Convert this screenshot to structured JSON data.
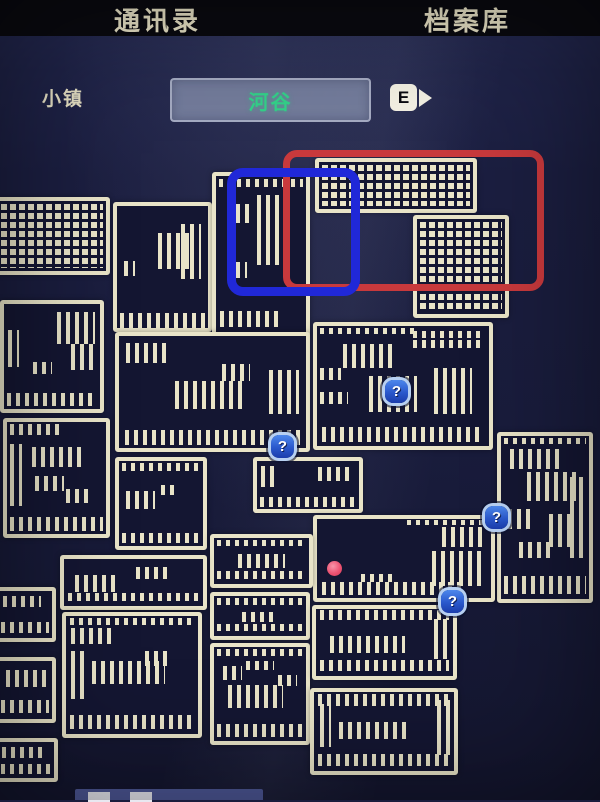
{
  "header": {
    "tabs": [
      {
        "id": "contacts",
        "label": "通讯录"
      },
      {
        "id": "archive",
        "label": "档案库"
      }
    ]
  },
  "location_bar": {
    "area_label": "小镇",
    "location_name": "河谷",
    "key_hint": "E"
  },
  "colors": {
    "background": "#1a1d3d",
    "room_fill": "#141632",
    "room_line": "#e9e4c8",
    "red_annotation": "#c8393c",
    "blue_annotation": "#2028d8",
    "marker_blue": "#2c5fd6",
    "player_pink": "#ec5372",
    "location_green": "#33d189"
  },
  "map": {
    "rooms": [
      {
        "x": -6,
        "y": 197,
        "w": 116,
        "h": 78,
        "p": "grid",
        "d": []
      },
      {
        "x": 113,
        "y": 202,
        "w": 99,
        "h": 130,
        "p": "s",
        "d": [
          [
            3,
            88,
            94,
            12
          ],
          [
            45,
            22,
            35,
            30
          ],
          [
            70,
            15,
            22,
            45
          ],
          [
            8,
            45,
            12,
            12
          ]
        ]
      },
      {
        "x": 212,
        "y": 172,
        "w": 98,
        "h": 165,
        "p": "s",
        "d": [
          [
            3,
            2,
            94,
            5
          ],
          [
            12,
            18,
            28,
            12
          ],
          [
            45,
            12,
            30,
            45
          ],
          [
            22,
            55,
            12,
            10
          ],
          [
            4,
            86,
            70,
            10
          ]
        ]
      },
      {
        "x": 315,
        "y": 158,
        "w": 162,
        "h": 55,
        "p": "grid",
        "d": []
      },
      {
        "x": 413,
        "y": 215,
        "w": 96,
        "h": 103,
        "p": "grid",
        "d": []
      },
      {
        "x": 0,
        "y": 300,
        "w": 104,
        "h": 113,
        "p": "s",
        "d": [
          [
            3,
            85,
            94,
            12
          ],
          [
            4,
            25,
            12,
            35
          ],
          [
            55,
            8,
            40,
            30
          ],
          [
            70,
            38,
            25,
            25
          ],
          [
            30,
            55,
            20,
            12
          ]
        ]
      },
      {
        "x": 115,
        "y": 332,
        "w": 195,
        "h": 120,
        "p": "s",
        "d": [
          [
            3,
            84,
            94,
            13
          ],
          [
            4,
            6,
            22,
            18
          ],
          [
            30,
            40,
            38,
            25
          ],
          [
            55,
            25,
            15,
            15
          ],
          [
            80,
            30,
            16,
            40
          ]
        ]
      },
      {
        "x": 313,
        "y": 322,
        "w": 180,
        "h": 128,
        "p": "s",
        "d": [
          [
            2,
            2,
            55,
            5
          ],
          [
            56,
            4,
            40,
            6
          ],
          [
            56,
            12,
            40,
            6
          ],
          [
            15,
            15,
            30,
            20
          ],
          [
            30,
            42,
            28,
            30
          ],
          [
            2,
            35,
            12,
            10
          ],
          [
            2,
            55,
            16,
            10
          ],
          [
            68,
            35,
            22,
            38
          ],
          [
            3,
            84,
            94,
            13
          ]
        ]
      },
      {
        "x": 497,
        "y": 432,
        "w": 96,
        "h": 171,
        "p": "s",
        "d": [
          [
            3,
            1,
            94,
            4
          ],
          [
            10,
            8,
            60,
            12
          ],
          [
            30,
            22,
            55,
            18
          ],
          [
            8,
            45,
            30,
            12
          ],
          [
            55,
            48,
            30,
            20
          ],
          [
            20,
            65,
            40,
            10
          ],
          [
            78,
            25,
            15,
            50
          ],
          [
            3,
            86,
            94,
            11
          ]
        ]
      },
      {
        "x": 3,
        "y": 418,
        "w": 107,
        "h": 120,
        "p": "s",
        "d": [
          [
            3,
            2,
            50,
            10
          ],
          [
            3,
            20,
            12,
            55
          ],
          [
            25,
            22,
            50,
            18
          ],
          [
            28,
            48,
            30,
            14
          ],
          [
            60,
            60,
            25,
            12
          ],
          [
            3,
            85,
            94,
            12
          ]
        ]
      },
      {
        "x": 115,
        "y": 457,
        "w": 92,
        "h": 93,
        "p": "s",
        "d": [
          [
            3,
            2,
            94,
            10
          ],
          [
            8,
            35,
            35,
            22
          ],
          [
            50,
            28,
            20,
            12
          ],
          [
            3,
            85,
            94,
            12
          ]
        ]
      },
      {
        "x": 253,
        "y": 457,
        "w": 110,
        "h": 56,
        "p": "s",
        "d": [
          [
            4,
            10,
            18,
            45
          ],
          [
            60,
            12,
            32,
            30
          ],
          [
            3,
            75,
            94,
            20
          ]
        ]
      },
      {
        "x": 313,
        "y": 515,
        "w": 182,
        "h": 87,
        "p": "s",
        "d": [
          [
            52,
            1,
            45,
            6
          ],
          [
            72,
            10,
            24,
            25
          ],
          [
            66,
            40,
            30,
            45
          ],
          [
            3,
            80,
            80,
            16
          ],
          [
            25,
            70,
            20,
            10
          ]
        ]
      },
      {
        "x": 210,
        "y": 534,
        "w": 103,
        "h": 54,
        "p": "s",
        "d": [
          [
            3,
            4,
            94,
            14
          ],
          [
            25,
            35,
            50,
            30
          ],
          [
            3,
            72,
            94,
            18
          ]
        ]
      },
      {
        "x": 210,
        "y": 592,
        "w": 100,
        "h": 48,
        "p": "s",
        "d": [
          [
            3,
            6,
            94,
            16
          ],
          [
            30,
            40,
            40,
            25
          ],
          [
            3,
            70,
            94,
            18
          ]
        ]
      },
      {
        "x": 60,
        "y": 555,
        "w": 147,
        "h": 55,
        "p": "s",
        "d": [
          [
            8,
            35,
            32,
            35
          ],
          [
            52,
            18,
            25,
            25
          ],
          [
            3,
            72,
            94,
            18
          ]
        ]
      },
      {
        "x": 62,
        "y": 612,
        "w": 140,
        "h": 126,
        "p": "s",
        "d": [
          [
            3,
            2,
            94,
            6
          ],
          [
            4,
            10,
            30,
            14
          ],
          [
            20,
            38,
            55,
            20
          ],
          [
            60,
            30,
            20,
            12
          ],
          [
            4,
            30,
            10,
            40
          ],
          [
            3,
            84,
            94,
            12
          ]
        ]
      },
      {
        "x": -6,
        "y": 587,
        "w": 62,
        "h": 55,
        "p": "s",
        "d": [
          [
            10,
            10,
            70,
            25
          ],
          [
            5,
            65,
            90,
            25
          ]
        ]
      },
      {
        "x": -6,
        "y": 657,
        "w": 62,
        "h": 66,
        "p": "s",
        "d": [
          [
            15,
            15,
            75,
            30
          ],
          [
            5,
            68,
            90,
            22
          ]
        ]
      },
      {
        "x": -6,
        "y": 738,
        "w": 64,
        "h": 44,
        "p": "s",
        "d": [
          [
            8,
            15,
            80,
            30
          ],
          [
            5,
            60,
            90,
            28
          ]
        ]
      },
      {
        "x": 210,
        "y": 643,
        "w": 100,
        "h": 102,
        "p": "s",
        "d": [
          [
            3,
            2,
            94,
            8
          ],
          [
            10,
            20,
            20,
            15
          ],
          [
            35,
            15,
            30,
            10
          ],
          [
            15,
            40,
            60,
            25
          ],
          [
            70,
            30,
            20,
            12
          ],
          [
            3,
            82,
            94,
            14
          ]
        ]
      },
      {
        "x": 312,
        "y": 605,
        "w": 145,
        "h": 75,
        "p": "s",
        "d": [
          [
            3,
            2,
            94,
            14
          ],
          [
            10,
            40,
            55,
            25
          ],
          [
            86,
            15,
            10,
            60
          ],
          [
            3,
            76,
            94,
            16
          ]
        ]
      },
      {
        "x": 310,
        "y": 688,
        "w": 148,
        "h": 87,
        "p": "s",
        "d": [
          [
            3,
            2,
            94,
            16
          ],
          [
            18,
            38,
            50,
            22
          ],
          [
            88,
            10,
            9,
            70
          ],
          [
            4,
            15,
            8,
            55
          ],
          [
            3,
            78,
            94,
            16
          ]
        ]
      }
    ],
    "annotations": [
      {
        "id": "red-box",
        "x": 283,
        "y": 150,
        "w": 247,
        "h": 127,
        "color": "#c8393c",
        "stroke": 7,
        "radius": 14
      },
      {
        "id": "blue-box",
        "x": 227,
        "y": 168,
        "w": 115,
        "h": 110,
        "color": "#2028d8",
        "stroke": 9,
        "radius": 16
      }
    ],
    "markers": [
      {
        "x": 397,
        "y": 392,
        "glyph": "?"
      },
      {
        "x": 283,
        "y": 447,
        "glyph": "?"
      },
      {
        "x": 497,
        "y": 518,
        "glyph": "?"
      },
      {
        "x": 453,
        "y": 602,
        "glyph": "?"
      }
    ],
    "player": {
      "x": 335,
      "y": 569
    },
    "legend_bar": {
      "x": 75,
      "y": 789,
      "w": 188,
      "h": 11,
      "squares": [
        88,
        130
      ]
    }
  }
}
